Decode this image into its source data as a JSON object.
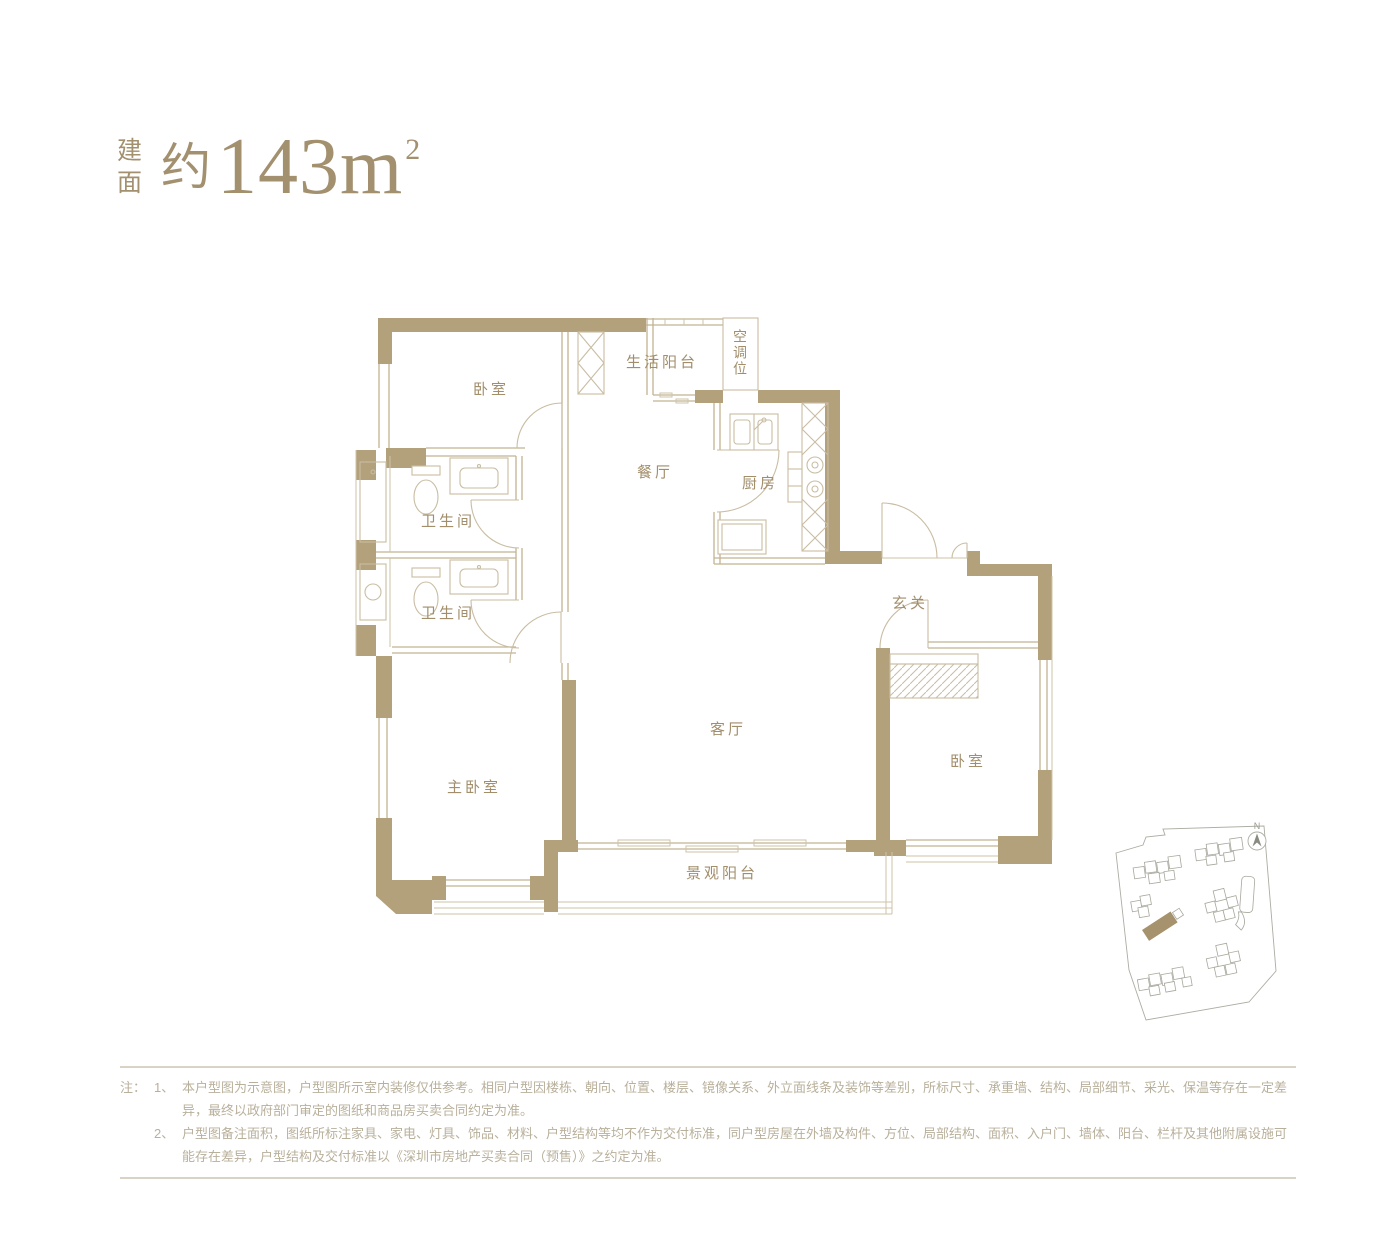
{
  "header": {
    "area_label_stacked": "建面",
    "area_approx": "约",
    "area_number": "143",
    "area_unit": "m",
    "area_superscript": "2"
  },
  "floor_plan": {
    "rooms": [
      {
        "key": "bedroom-top-left",
        "label": "卧室"
      },
      {
        "key": "living-balcony",
        "label": "生活阳台"
      },
      {
        "key": "ac-unit-slot",
        "label": "空调位"
      },
      {
        "key": "dining-room",
        "label": "餐厅"
      },
      {
        "key": "kitchen",
        "label": "厨房"
      },
      {
        "key": "bathroom-1",
        "label": "卫生间"
      },
      {
        "key": "bathroom-2",
        "label": "卫生间"
      },
      {
        "key": "foyer",
        "label": "玄关"
      },
      {
        "key": "master-bedroom",
        "label": "主卧室"
      },
      {
        "key": "living-room",
        "label": "客厅"
      },
      {
        "key": "bedroom-right",
        "label": "卧室"
      },
      {
        "key": "view-balcony",
        "label": "景观阳台"
      }
    ],
    "wall_color": "#b3a17c",
    "line_color": "#c2b392",
    "label_color": "#a28e6b"
  },
  "site_map": {
    "compass_label": "N",
    "highlight_color": "#a6926c"
  },
  "notes": {
    "prefix": "注：",
    "items": [
      {
        "no": "1、",
        "text": "本户型图为示意图，户型图所示室内装修仅供参考。相同户型因楼栋、朝向、位置、楼层、镜像关系、外立面线条及装饰等差别，所标尺寸、承重墙、结构、局部细节、采光、保温等存在一定差异，最终以政府部门审定的图纸和商品房买卖合同约定为准。"
      },
      {
        "no": "2、",
        "text": "户型图备注面积，图纸所标注家具、家电、灯具、饰品、材料、户型结构等均不作为交付标准，同户型房屋在外墙及构件、方位、局部结构、面积、入户门、墙体、阳台、栏杆及其他附属设施可能存在差异，户型结构及交付标准以《深圳市房地产买卖合同（预售）》之约定为准。"
      }
    ]
  }
}
